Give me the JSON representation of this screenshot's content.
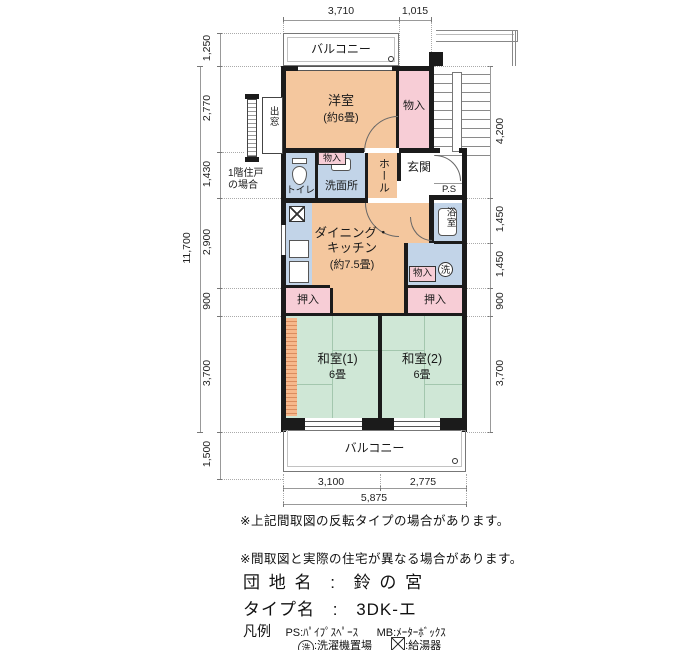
{
  "plan": {
    "rooms": {
      "balcony_top": "バルコニー",
      "balcony_bottom": "バルコニー",
      "yoshitsu": "洋室",
      "yoshitsu_size": "(約6畳)",
      "monoire_top": "物入",
      "monoire_mid": "物入",
      "monoire_right": "物入",
      "toilet": "トイレ",
      "senmenjo": "洗面所",
      "hall": "ホール",
      "genkan": "玄関",
      "ps": "P.S",
      "dk_line1": "ダイニング・",
      "dk_line2": "キッチン",
      "dk_size": "(約7.5畳)",
      "bath": "浴室",
      "laundry_symbol": "洗",
      "oshiire_left": "押入",
      "oshiire_right": "押入",
      "washitsu1": "和室(1)",
      "washitsu1_size": "6畳",
      "washitsu2": "和室(2)",
      "washitsu2_size": "6畳",
      "demado": "出窓",
      "floor1_line1": "1階住戸",
      "floor1_line2": "の場合"
    },
    "dims": {
      "top": [
        "3,710",
        "1,015"
      ],
      "left": [
        "1,250",
        "2,770",
        "1,430",
        "2,900",
        "900",
        "3,700",
        "1,500"
      ],
      "left_total": "11,700",
      "right": [
        "4,200",
        "1,450",
        "1,450",
        "900",
        "3,700"
      ],
      "bottom": [
        "3,100",
        "2,775"
      ],
      "bottom_total": "5,875"
    }
  },
  "notes": {
    "note1": "※上記間取図の反転タイプの場合があります。",
    "note2": "※間取図と実際の住宅が異なる場合があります。"
  },
  "info": {
    "danchi_label": "団 地 名",
    "danchi_sep": ":",
    "danchi_value": "鈴 の 宮",
    "type_label": "タイプ名",
    "type_sep": ":",
    "type_value": "3DK-エ",
    "legend_title": "凡例",
    "legend_ps": "PS:ﾊﾟｲﾌﾟｽﾍﾟｰｽ",
    "legend_mb": "MB:ﾒｰﾀｰﾎﾞｯｸｽ",
    "legend_sen_symbol": "洗",
    "legend_sen_text": ":洗濯機置場",
    "legend_kyuto_text": ":給湯器"
  },
  "colors": {
    "room_warm": "#f4c79e",
    "closet_pink": "#f7cdd6",
    "wet_blue": "#c2d4e8",
    "tatami_green": "#cfe7d6",
    "wall": "#1b1b1b"
  }
}
